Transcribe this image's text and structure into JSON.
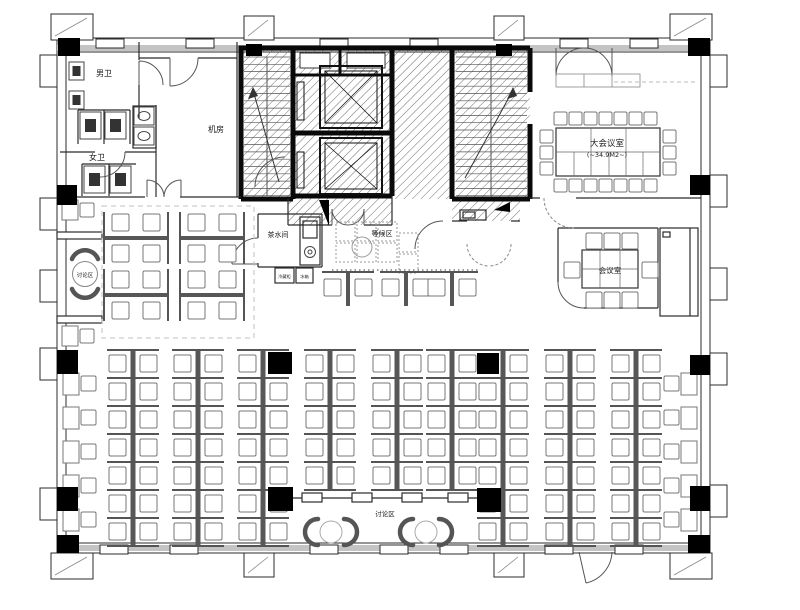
{
  "plan": {
    "rooms": {
      "mens_room": "男卫",
      "womens_room": "女卫",
      "machine_room": "机房",
      "tea_room": "茶水间",
      "waiting_area": "等候区",
      "discussion_left": "讨论区",
      "discussion_bottom": "讨论区",
      "large_meeting_room": "大会议室",
      "large_meeting_area": "(~34.9M2~)",
      "meeting_room": "会议室",
      "fridge": "冷藏柜",
      "icebox": "冰箱"
    },
    "colors": {
      "line": "#2b2b2b",
      "wall_black": "#0a0a0a",
      "glazing": "#c4c4c4",
      "hatch": "#707070",
      "furniture": "#777777"
    }
  }
}
